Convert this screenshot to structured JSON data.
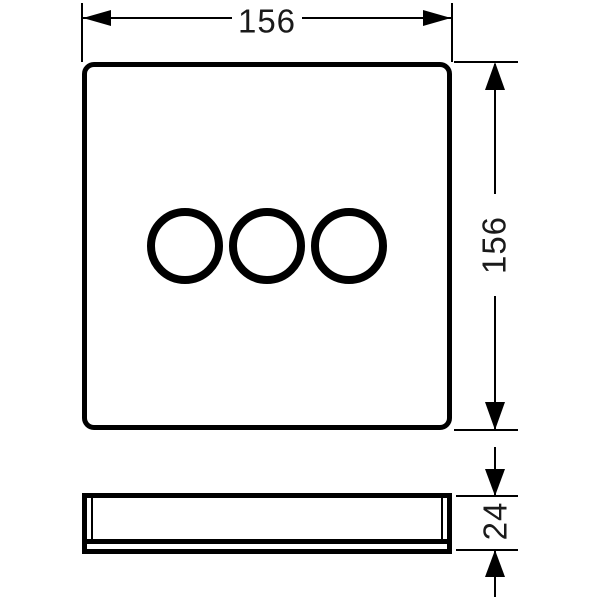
{
  "drawing": {
    "type": "technical-dimension-drawing",
    "dimensions": {
      "width": "156",
      "height": "156",
      "depth": "24"
    },
    "views": {
      "front": {
        "shape": "rounded-square-plate",
        "circle_count": 3
      },
      "side": {
        "shape": "flat-profile-with-rim"
      }
    },
    "colors": {
      "background": "#ffffff",
      "line": "#000000",
      "text": "#1a1a1a"
    }
  }
}
